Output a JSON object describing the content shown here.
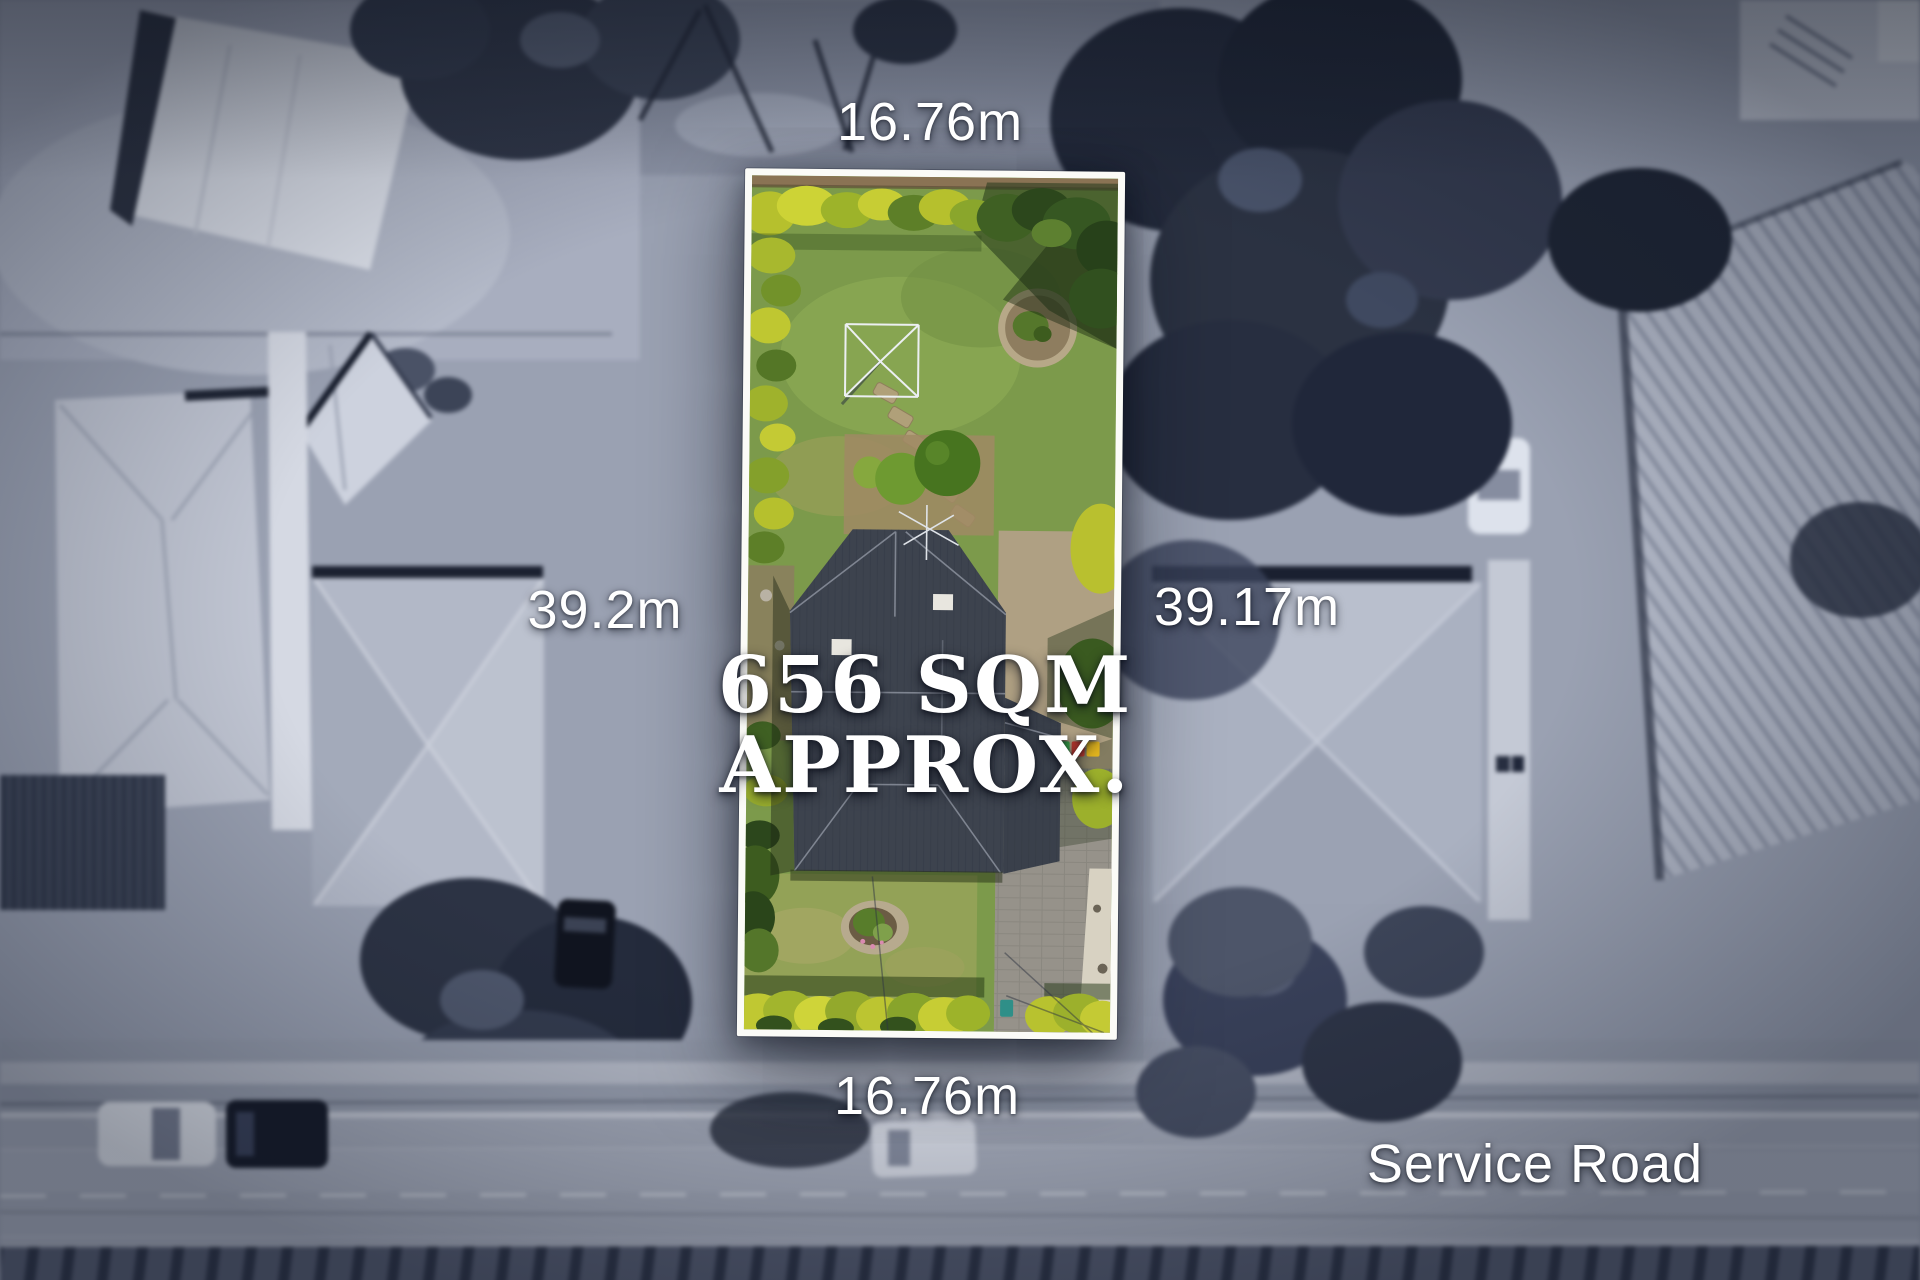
{
  "annotations": {
    "top_width": "16.76m",
    "bottom_width": "16.76m",
    "left_length": "39.2m",
    "right_length": "39.17m",
    "area": {
      "line1": "656 SQM",
      "line2": "APPROX."
    },
    "road_name": "Service Road"
  },
  "colors": {
    "boundary_white": "#fbfbf7",
    "label_white": "#ffffff",
    "back_lawn_green": "#7c9a4b",
    "front_lawn_green": "#93a257",
    "hedge_chartreuse": "#c0c832",
    "roof_slate": "#3d434e",
    "driveway_gray": "#96928a",
    "background_gray": "#9aa1b2",
    "bin_green": "#3aa94a",
    "bin_red": "#c23b30",
    "bin_yellow": "#e2b51e"
  }
}
